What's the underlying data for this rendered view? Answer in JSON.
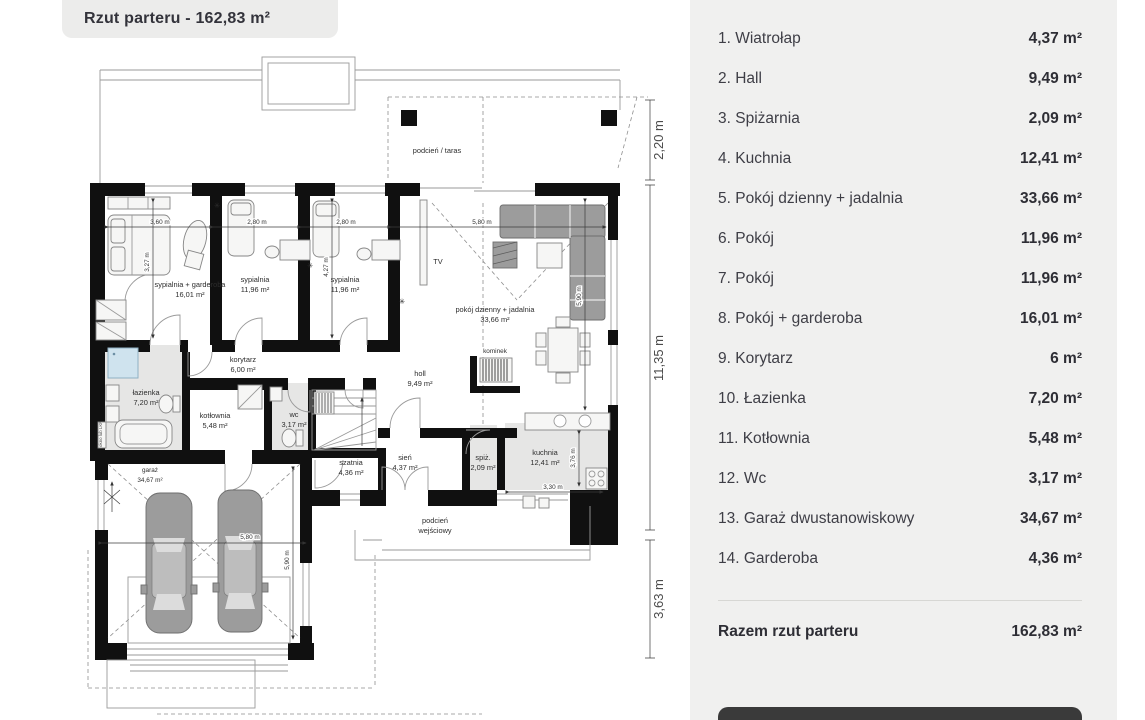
{
  "header": {
    "title": "Rzut parteru - 162,83 m²"
  },
  "rooms": [
    {
      "label": "1. Wiatrołap",
      "area": "4,37 m²"
    },
    {
      "label": "2. Hall",
      "area": "9,49 m²"
    },
    {
      "label": "3. Spiżarnia",
      "area": "2,09 m²"
    },
    {
      "label": "4. Kuchnia",
      "area": "12,41 m²"
    },
    {
      "label": "5. Pokój dzienny + jadalnia",
      "area": "33,66 m²"
    },
    {
      "label": "6. Pokój",
      "area": "11,96 m²"
    },
    {
      "label": "7. Pokój",
      "area": "11,96 m²"
    },
    {
      "label": "8. Pokój + garderoba",
      "area": "16,01 m²"
    },
    {
      "label": "9. Korytarz",
      "area": "6 m²"
    },
    {
      "label": "10. Łazienka",
      "area": "7,20 m²"
    },
    {
      "label": "11. Kotłownia",
      "area": "5,48 m²"
    },
    {
      "label": "12. Wc",
      "area": "3,17 m²"
    },
    {
      "label": "13. Garaż dwustanowiskowy",
      "area": "34,67 m²"
    },
    {
      "label": "14. Garderoba",
      "area": "4,36 m²"
    }
  ],
  "total": {
    "label": "Razem rzut parteru",
    "value": "162,83 m²"
  },
  "plan": {
    "labels": {
      "taras": "podcień / taras",
      "bed1a": "sypialnia + garderoba",
      "bed1b": "16,01 m²",
      "bed2a": "sypialnia",
      "bed2b": "11,96 m²",
      "bed3a": "sypialnia",
      "bed3b": "11,96 m²",
      "liva": "pokój dzienny + jadalnia",
      "livb": "33,66 m²",
      "tv": "TV",
      "kominek": "kominek",
      "holla": "holl",
      "hollb": "9,49 m²",
      "kora": "korytarz",
      "korb": "6,00 m²",
      "laza": "łazienka",
      "lazb": "7,20 m²",
      "kota": "kotłownia",
      "kotb": "5,48 m²",
      "wca": "wc",
      "wcb": "3,17 m²",
      "siena": "sień",
      "sienb": "4,37 m²",
      "szaa": "szatnia",
      "szab": "4,36 m²",
      "spia": "spiż.",
      "spib": "2,09 m²",
      "kucha": "kuchnia",
      "kuchb": "12,41 m²",
      "gara": "garaż",
      "garb": "34,67 m²",
      "podca": "podcień",
      "podcb": "wejściowy",
      "okno": "okno lub LKF"
    },
    "dims": {
      "t1": "3,60 m",
      "t2": "2,80 m",
      "t3": "2,80 m",
      "t4": "5,80 m",
      "v1": "3,27 m",
      "v2": "4,27 m",
      "v3": "5,90 m",
      "k1": "3,30 m",
      "k2": "3,76 m",
      "g1": "5,80 m",
      "g2": "5,90 m",
      "r1": "2,20 m",
      "r2": "11,35 m",
      "r3": "3,63 m"
    }
  },
  "colors": {
    "panel_bg": "#f0f0ef",
    "tab_bg": "#ececeb",
    "button_bg": "#3a3a3a",
    "text_dark": "#2e2e35",
    "shower_blue": "#cfe3ee",
    "wall_black": "#101010"
  }
}
